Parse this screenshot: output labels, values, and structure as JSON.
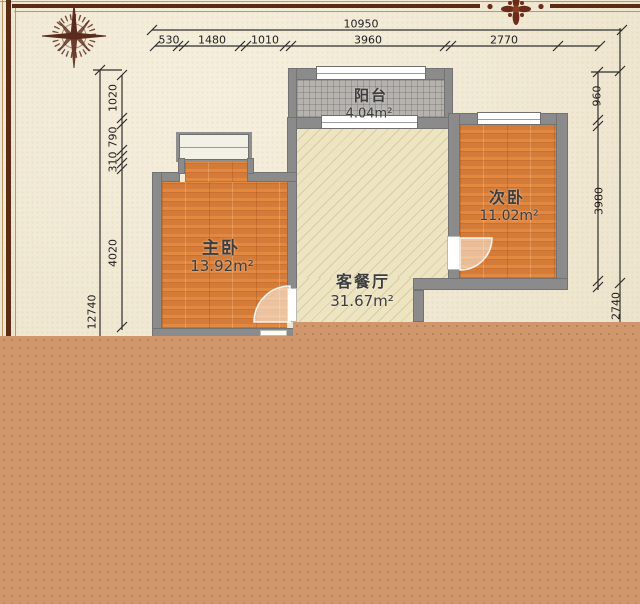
{
  "plan": {
    "rooms": {
      "balcony": {
        "name": "阳台",
        "area": "4.04m²"
      },
      "master_bedroom": {
        "name": "主卧",
        "area": "13.92m²"
      },
      "second_bedroom": {
        "name": "次卧",
        "area": "11.02m²"
      },
      "living_dining": {
        "name": "客餐厅",
        "area": "31.67m²"
      }
    },
    "dims": {
      "top_total": "10950",
      "top_segments": [
        "530",
        "1480",
        "1010",
        "3960",
        "2770"
      ],
      "left_segments": [
        "1020",
        "790",
        "310",
        "4020"
      ],
      "left_total": "12740",
      "right_segments": [
        "960",
        "3980",
        "2740"
      ]
    },
    "icons": {
      "compass": "compass-rose-icon",
      "ornament": "floral-ornament-icon"
    },
    "colors": {
      "parchment": "#f1e9d1",
      "frame_dark": "#5c2b13",
      "wall": "#8b8b8b",
      "wood_floor": "#e0843e",
      "tile_floor": "#b6b3ae",
      "hatch_floor": "#ede4c2",
      "lower_panel": "#cf976b",
      "dimension_line": "#2e2e2e",
      "ornament_red": "#6b2c1a"
    }
  }
}
